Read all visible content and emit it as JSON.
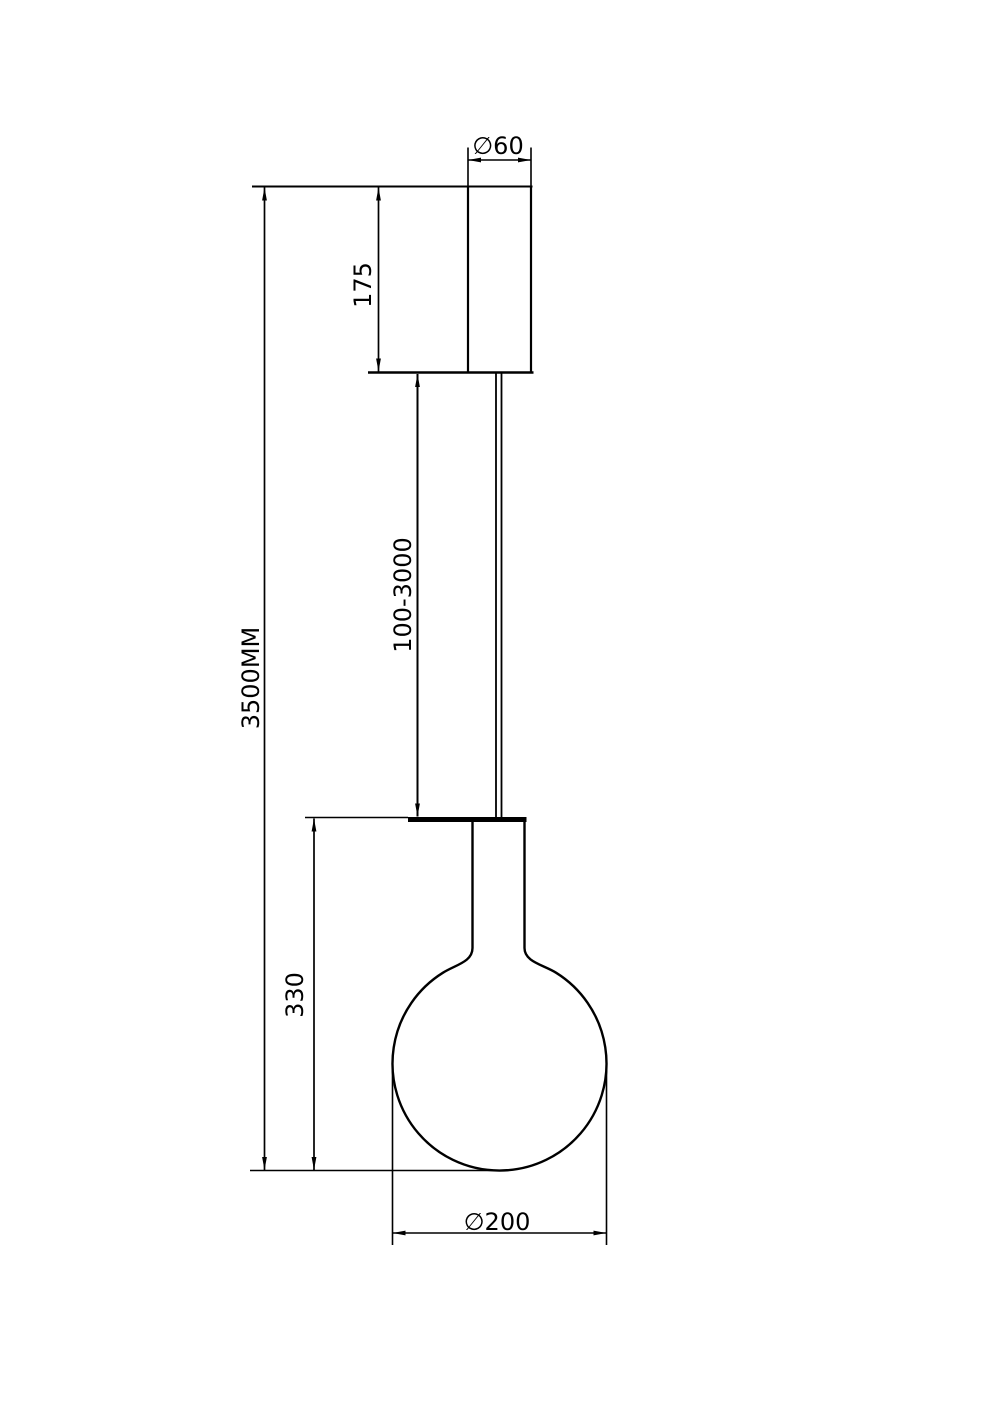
{
  "drawing": {
    "background_color": "#ffffff",
    "line_color": "#000000",
    "labels": {
      "canopy_diameter": "∅60",
      "canopy_height": "175",
      "suspension_length": "100-3000",
      "overall_height": "3500MM",
      "bulb_section_height": "330",
      "globe_diameter": "∅200"
    }
  }
}
